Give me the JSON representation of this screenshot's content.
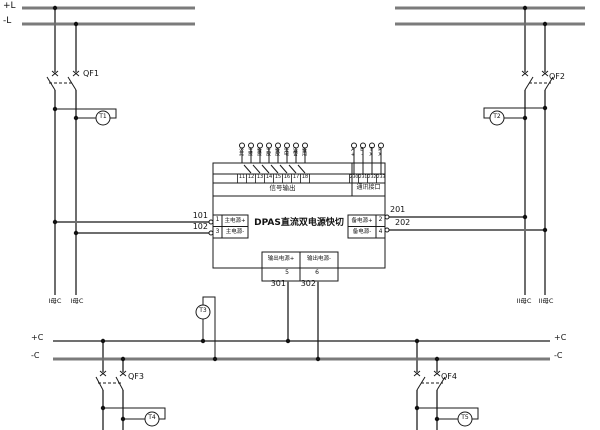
{
  "colors": {
    "bus_gray": "#7b7b7b",
    "wire_gray": "#6e6e6e",
    "ink": "#1a1a1a"
  },
  "bus_top": {
    "plus": "+L",
    "minus": "-L"
  },
  "bus_bottom": {
    "plus": "+C",
    "minus": "-C"
  },
  "bus_tags": {
    "b1a": "I母C",
    "b1b": "I母C",
    "b2a": "II母C",
    "b2b": "II母C"
  },
  "breakers": {
    "qf1": "QF1",
    "qf2": "QF2",
    "qf3": "QF3",
    "qf4": "QF4"
  },
  "meters": {
    "t1": "T1",
    "t2": "T2",
    "t3": "T3",
    "t4": "T4",
    "t5": "T5"
  },
  "wires": {
    "w101": "101",
    "w102": "102",
    "w201": "201",
    "w202": "202",
    "w301": "301",
    "w302": "302"
  },
  "device": {
    "title": "DPAS直流双电源快切",
    "signal_group": {
      "label": "信号输出",
      "terminals": [
        {
          "no": "11",
          "tag": "公共"
        },
        {
          "no": "12",
          "tag": "主投"
        },
        {
          "no": "13",
          "tag": "备投"
        },
        {
          "no": "14",
          "tag": "主故"
        },
        {
          "no": "15",
          "tag": "备故"
        },
        {
          "no": "16",
          "tag": "失电"
        },
        {
          "no": "17",
          "tag": "告警"
        },
        {
          "no": "18",
          "tag": "备用"
        }
      ]
    },
    "comm_group": {
      "label": "通讯接口",
      "terminals": [
        {
          "no": "230",
          "tag": "A+"
        },
        {
          "no": "231",
          "tag": "B-"
        },
        {
          "no": "232",
          "tag": "TX"
        },
        {
          "no": "233",
          "tag": "RX"
        }
      ]
    },
    "main_in": {
      "rows": [
        {
          "no": "1",
          "label": "主电源+"
        },
        {
          "no": "3",
          "label": "主电源-"
        }
      ]
    },
    "backup_in": {
      "rows": [
        {
          "no": "2",
          "label": "备电源+"
        },
        {
          "no": "4",
          "label": "备电源-"
        }
      ]
    },
    "output": {
      "cells": [
        {
          "no": "5",
          "label": "输出电源+"
        },
        {
          "no": "6",
          "label": "输出电源-"
        }
      ]
    }
  }
}
